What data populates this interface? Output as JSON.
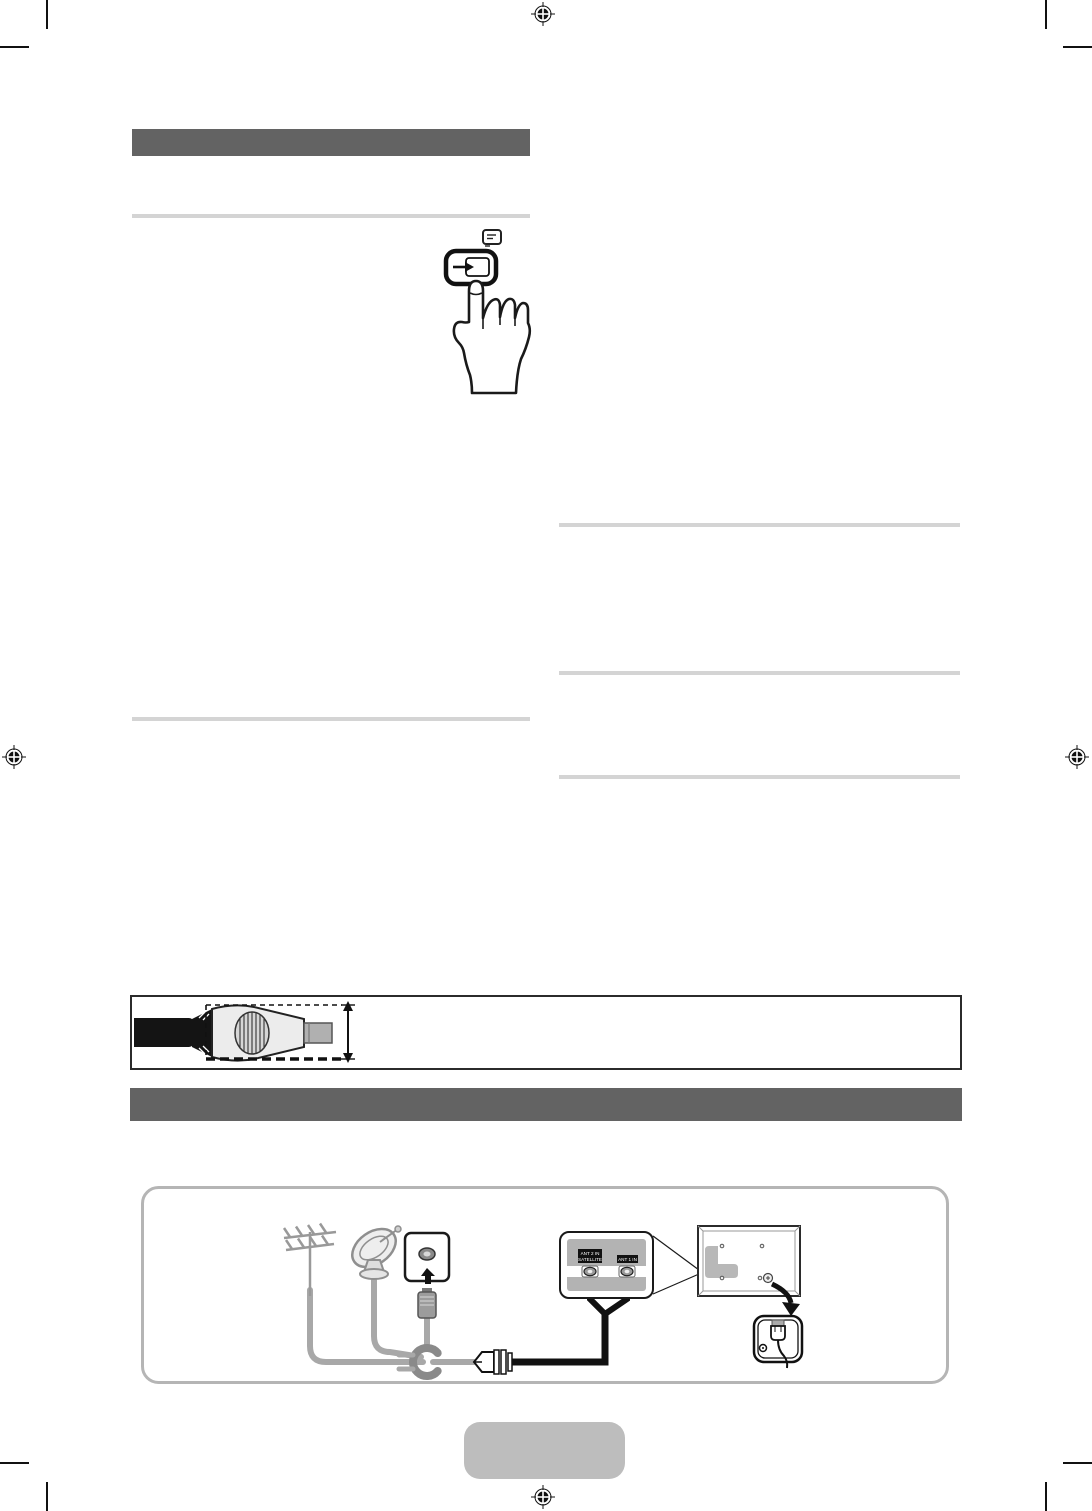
{
  "page": {
    "kind": "tv-manual-print-page",
    "background": "#ffffff"
  },
  "colors": {
    "section_bar": "#636363",
    "rule": "#d4d4d4",
    "ink": "#1a1a1a",
    "cable_gray": "#a8a8a8",
    "panel_gray": "#b3b3b3",
    "diagram_border": "#b5b5b5",
    "footer_tab": "#bdbdbd"
  },
  "connection_diagram": {
    "port_left": {
      "line1": "ANT 2 IN",
      "line2": "SATELLITE"
    },
    "port_right": {
      "line1": "ANT 1 IN"
    }
  },
  "icons": {
    "registration-mark": "crosshair-target-circle",
    "crop-mark": "corner-trim-line",
    "note-icon": "small-list-badge",
    "enter-button-icon": "arrow-into-slot",
    "pressing-hand-icon": "hand-with-extended-finger",
    "antenna-icon": "vhf-uhf-aerial",
    "satellite-dish-icon": "satellite-dish",
    "wall-outlet-icon": "antenna-wall-socket",
    "coax-plug-icon": "coax-connector",
    "cable-ring-icon": "open-ring-cable-bundle",
    "tv-rear-icon": "tv-back-panel",
    "power-outlet-icon": "mains-plug-in-socket",
    "height-arrow-icon": "vertical-double-arrow",
    "connector-cable-icon": "cable-connector-profile"
  }
}
